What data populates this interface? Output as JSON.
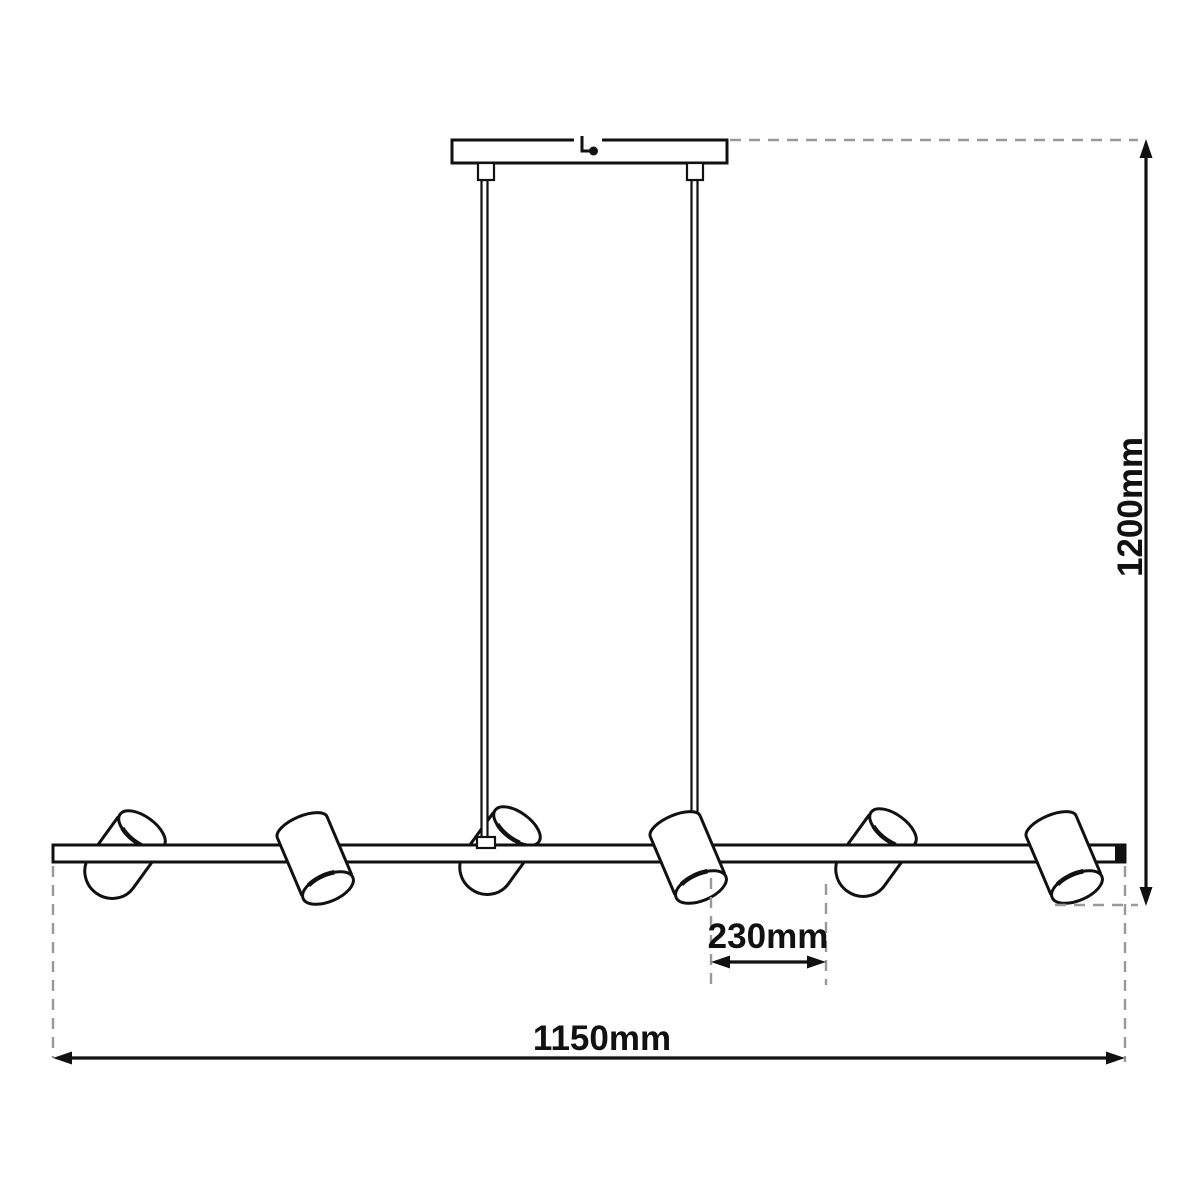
{
  "diagram": {
    "kind": "technical-dimension-drawing",
    "fixture": "linear pendant bar with ceiling canopy, 2 suspension rods and 6 tilted cylindrical spotlights",
    "spotlight_count": 6,
    "labels": {
      "height": "1200mm",
      "length": "1150mm",
      "spacing": "230mm"
    },
    "colors": {
      "outline": "#111111",
      "dash": "#999999",
      "background": "#ffffff"
    }
  }
}
